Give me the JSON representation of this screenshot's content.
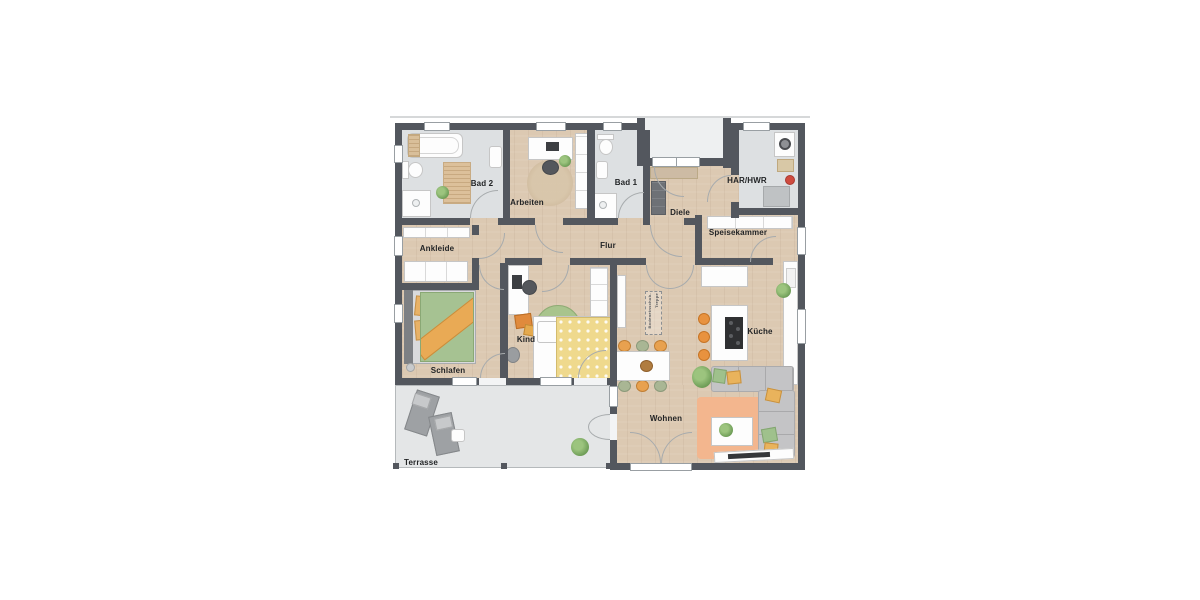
{
  "plan": {
    "rooms": {
      "bad2": "Bad 2",
      "arbeiten": "Arbeiten",
      "bad1": "Bad 1",
      "har_hwr": "HAR/HWR",
      "diele": "Diele",
      "speisekammer": "Speisekammer",
      "ankleide": "Ankleide",
      "flur": "Flur",
      "schlafen": "Schlafen",
      "kind": "Kind",
      "kueche": "Küche",
      "wohnen": "Wohnen",
      "terrasse": "Terrasse"
    },
    "annotations": {
      "attic_stairs_line1": "Bodeneinschub-",
      "attic_stairs_line2": "Treppe",
      "wall_marker": "BT"
    },
    "colors": {
      "wall": "#53575e",
      "wood_floor": "#dcc9b2",
      "tile_floor": "#dde0e2",
      "terrace_floor": "#e4e6e7",
      "accent_orange": "#e8923f",
      "accent_green": "#a9c48d",
      "accent_salmon": "#f3b68e"
    }
  }
}
